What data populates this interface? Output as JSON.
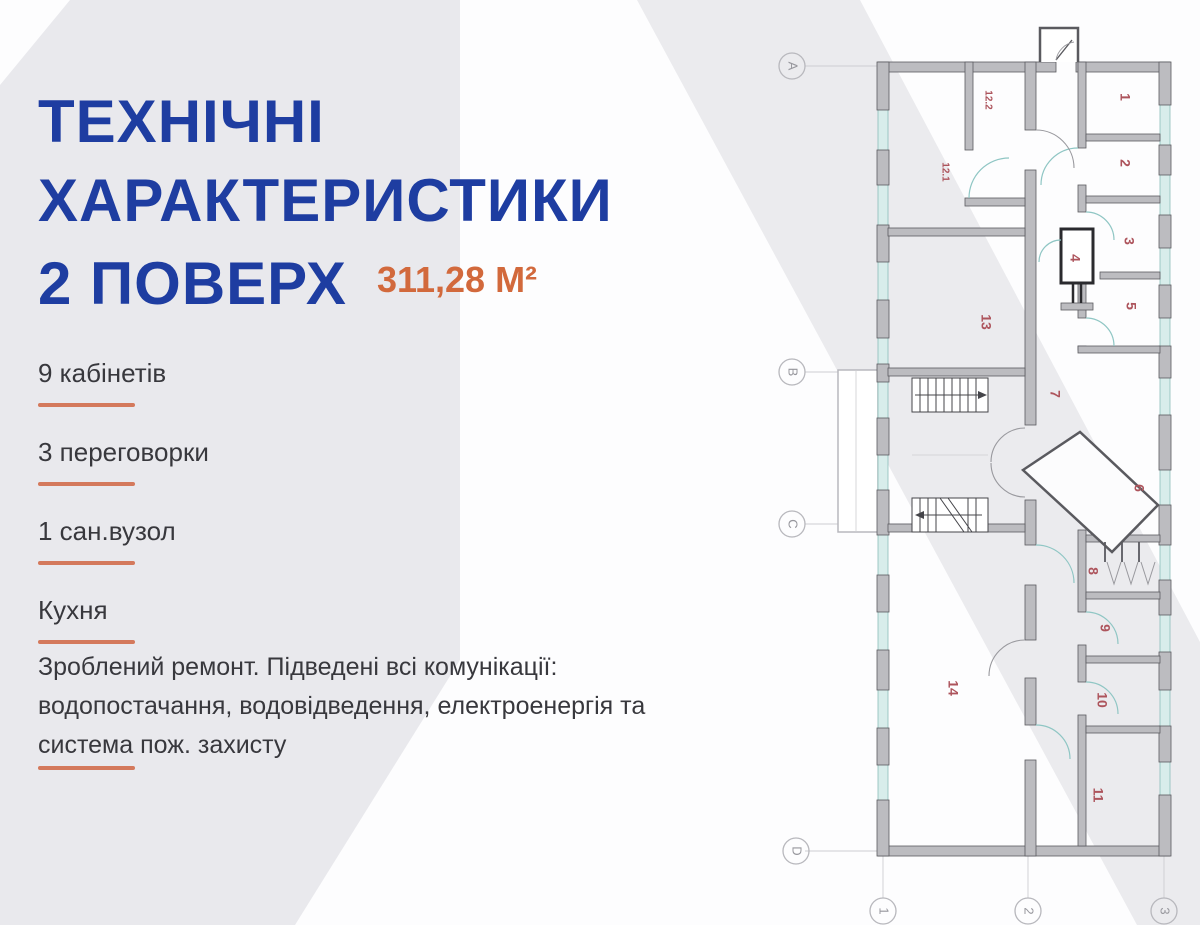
{
  "page": {
    "title_lines": [
      "ТЕХНІЧНІ",
      "ХАРАКТЕРИСТИКИ",
      "2 ПОВЕРХ"
    ],
    "area_value": "311,28 М²",
    "features": [
      {
        "label": "9 кабінетів"
      },
      {
        "label": "3 переговорки"
      },
      {
        "label": "1 сан.вузол"
      },
      {
        "label": "Кухня"
      }
    ],
    "description": "Зроблений ремонт. Підведені всі комунікації: водопостачання, водовідведення, електроенергія та система пож. захисту"
  },
  "floor_plan": {
    "rooms": [
      {
        "label": "1",
        "x": 364,
        "y": 97
      },
      {
        "label": "2",
        "x": 364,
        "y": 163
      },
      {
        "label": "3",
        "x": 368,
        "y": 241
      },
      {
        "label": "4",
        "x": 314,
        "y": 258
      },
      {
        "label": "5",
        "x": 370,
        "y": 306
      },
      {
        "label": "6",
        "x": 378,
        "y": 488
      },
      {
        "label": "7",
        "x": 294,
        "y": 394
      },
      {
        "label": "8",
        "x": 332,
        "y": 571
      },
      {
        "label": "9",
        "x": 344,
        "y": 628
      },
      {
        "label": "10",
        "x": 341,
        "y": 700
      },
      {
        "label": "11",
        "x": 337,
        "y": 795
      },
      {
        "label": "12.2",
        "x": 228,
        "y": 100,
        "fs": 10
      },
      {
        "label": "12.1",
        "x": 185,
        "y": 172,
        "fs": 10
      },
      {
        "label": "13",
        "x": 225,
        "y": 322
      },
      {
        "label": "14",
        "x": 192,
        "y": 688
      }
    ],
    "grid_rows": [
      {
        "label": "A",
        "x": 32,
        "y": 66
      },
      {
        "label": "B",
        "x": 32,
        "y": 372
      },
      {
        "label": "C",
        "x": 32,
        "y": 524
      },
      {
        "label": "D",
        "x": 36,
        "y": 851
      }
    ],
    "grid_cols": [
      {
        "label": "1",
        "x": 123,
        "y": 911
      },
      {
        "label": "2",
        "x": 268,
        "y": 911
      },
      {
        "label": "3",
        "x": 404,
        "y": 911
      }
    ]
  },
  "colors": {
    "title_blue": "#1e3da1",
    "accent_orange": "#d2693c",
    "underline_orange": "#d4795c",
    "body_text": "#38383d",
    "panel_gray": "#e9e9ed",
    "band_gray": "#ebebee",
    "room_label_red": "#ad545c",
    "wall_fill": "#bcbcc0",
    "wall_stroke": "#5a5a5f",
    "window_fill": "#d8edeb",
    "window_stroke": "#8bbcba",
    "door_teal": "#8fc6c4",
    "door_gray": "#99999e",
    "grid_line": "#cdcdd1",
    "bubble_stroke": "#b8b8bd",
    "bubble_text": "#96969c"
  }
}
